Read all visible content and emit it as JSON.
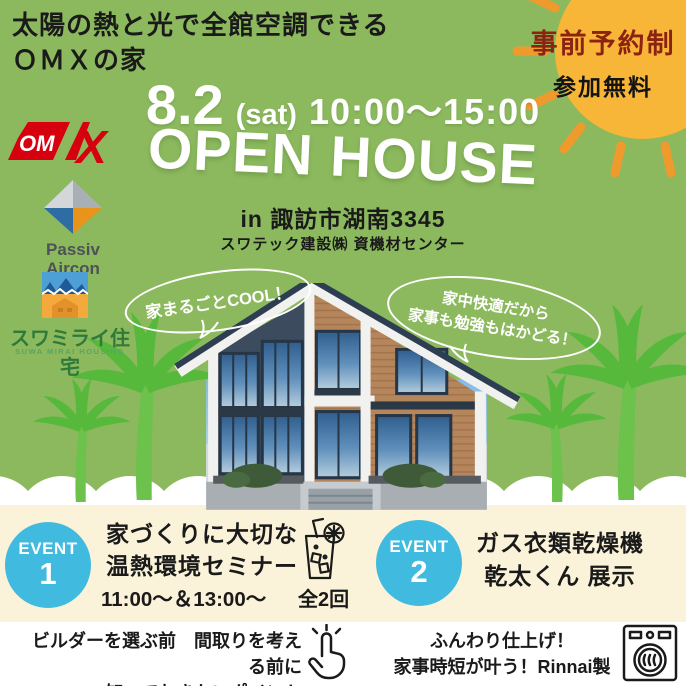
{
  "colors": {
    "background_green": "#8cb95e",
    "palm_green": "#56b93b",
    "cream": "#faf3d9",
    "sun_yellow": "#f7b637",
    "sun_ray_orange": "#ef9a2d",
    "reserve_text_red": "#8c2212",
    "event_circle_blue": "#41badf",
    "omx_red": "#d7000f",
    "suwa_green": "#2f7a3b"
  },
  "header": {
    "line1": "太陽の熱と光で全館空調できる",
    "line2": "ＯＭＸの家"
  },
  "sun_badge": {
    "line1": "事前予約制",
    "line2": "参加無料"
  },
  "main": {
    "date": "8.2",
    "day": "(sat)",
    "time": "10:00〜15:00",
    "title": "OPEN HOUSE",
    "location": "in 諏訪市湖南3345",
    "venue": "スワテック建設㈱ 資機材センター"
  },
  "logos": {
    "omx": {
      "om": "OM",
      "x": "X"
    },
    "passiv": {
      "line1": "Passiv",
      "line2": "Aircon"
    },
    "suwa": {
      "name": "スワミライ住宅",
      "sub": "SUWA MIRAI HOUSING"
    }
  },
  "bubbles": {
    "left": {
      "text": "家まるごとCOOL！"
    },
    "right": {
      "line1": "家中快適だから",
      "line2": "家事も勉強もはかどる！"
    }
  },
  "events": [
    {
      "badge": "EVENT",
      "number": "1",
      "line1": "家づくりに大切な",
      "line2": "温熱環境セミナー",
      "time": "11:00〜＆13:00〜",
      "note": "全2回"
    },
    {
      "badge": "EVENT",
      "number": "2",
      "line1": "ガス衣類乾燥機",
      "line2": "乾太くん 展示"
    }
  ],
  "footer": {
    "left": {
      "line1": "ビルダーを選ぶ前　間取りを考える前に",
      "line2": "知っておきたいポイント"
    },
    "right": {
      "line1": "ふんわり仕上げ！",
      "line2": "家事時短が叶う！Rinnai製"
    }
  },
  "icons": {
    "sun": "sun-icon",
    "palm": "palm-tree-icon",
    "drink": "drink-glass-icon",
    "tap": "tap-hand-icon",
    "washer": "dryer-machine-icon"
  }
}
